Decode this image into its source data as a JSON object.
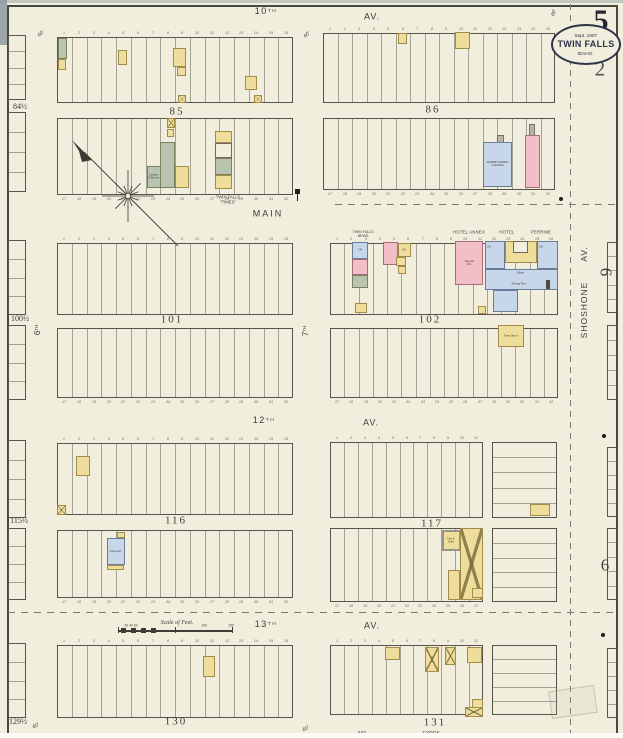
{
  "sheet": {
    "page_number": "5",
    "secondary_number": "2",
    "badge": {
      "line1": "Sept. 1907",
      "line2": "TWIN FALLS",
      "line3": "IDAHO."
    },
    "scale_label": "Scale of Feet.",
    "paper_color": "#f1eede",
    "ink_color": "#3e3d33",
    "building_colors": {
      "yellow": "#efdd9b",
      "pink": "#f2bec8",
      "blue": "#c7d6e9",
      "green": "#b9c3ad",
      "gray": "#b5b5ac"
    }
  },
  "texts": [
    {
      "t": "10",
      "sup": "TH",
      "x": 266,
      "y": 12,
      "fs": 9,
      "ls": 1.5
    },
    {
      "t": "AV.",
      "x": 372,
      "y": 17,
      "fs": 9,
      "ls": 1
    },
    {
      "t": "MAIN",
      "x": 268,
      "y": 214,
      "fs": 9,
      "ls": 2
    },
    {
      "t": "12",
      "sup": "TH",
      "x": 264,
      "y": 421,
      "fs": 9,
      "ls": 1.5
    },
    {
      "t": "AV.",
      "x": 371,
      "y": 423,
      "fs": 9,
      "ls": 1
    },
    {
      "t": "13",
      "sup": "TH",
      "x": 266,
      "y": 625,
      "fs": 9,
      "ls": 1.5
    },
    {
      "t": "AV.",
      "x": 372,
      "y": 626,
      "fs": 9,
      "ls": 1
    },
    {
      "t": "SHOSHONE",
      "x": 584,
      "y": 310,
      "fs": 8.5,
      "rot": -90,
      "ls": 1
    },
    {
      "t": "AV.",
      "x": 584,
      "y": 254,
      "fs": 8.5,
      "rot": -90,
      "ls": 1
    },
    {
      "t": "6",
      "sup": "TH",
      "x": 38,
      "y": 330,
      "fs": 8,
      "rot": -90
    },
    {
      "t": "7",
      "sup": "TH",
      "x": 306,
      "y": 331,
      "fs": 8,
      "rot": -90
    },
    {
      "t": "85",
      "x": 177,
      "y": 112,
      "fs": 11,
      "serif": 1,
      "ls": 2
    },
    {
      "t": "86",
      "x": 433,
      "y": 110,
      "fs": 11,
      "serif": 1,
      "ls": 2
    },
    {
      "t": "101",
      "x": 172,
      "y": 320,
      "fs": 11,
      "serif": 1,
      "ls": 2
    },
    {
      "t": "102",
      "x": 430,
      "y": 320,
      "fs": 11,
      "serif": 1,
      "ls": 2
    },
    {
      "t": "116",
      "x": 176,
      "y": 521,
      "fs": 11,
      "serif": 1,
      "ls": 2
    },
    {
      "t": "117",
      "x": 432,
      "y": 524,
      "fs": 11,
      "serif": 1,
      "ls": 2
    },
    {
      "t": "130",
      "x": 176,
      "y": 722,
      "fs": 11,
      "serif": 1,
      "ls": 2
    },
    {
      "t": "131",
      "x": 435,
      "y": 723,
      "fs": 11,
      "serif": 1,
      "ls": 2
    },
    {
      "t": "84½",
      "x": 20,
      "y": 107,
      "fs": 8,
      "serif": 1
    },
    {
      "t": "100½",
      "x": 20,
      "y": 319,
      "fs": 8,
      "serif": 1
    },
    {
      "t": "115½",
      "x": 19,
      "y": 521,
      "fs": 8,
      "serif": 1
    },
    {
      "t": "129½",
      "x": 18,
      "y": 722,
      "fs": 8,
      "serif": 1
    },
    {
      "t": "5",
      "x": 601,
      "y": 21,
      "fs": 30,
      "serif": 1,
      "bold": 1,
      "col": "#26262e"
    },
    {
      "t": "2",
      "x": 600,
      "y": 69,
      "fs": 21,
      "serif": 1,
      "col": "#54544e"
    },
    {
      "t": "6",
      "x": 606,
      "y": 272,
      "fs": 17,
      "serif": 1,
      "rot": 90,
      "col": "#45453e"
    },
    {
      "t": "6",
      "x": 605,
      "y": 565,
      "fs": 17,
      "serif": 1,
      "col": "#45453e"
    },
    {
      "t": "TWIN FALLS",
      "x": 228,
      "y": 197,
      "fs": 4.2
    },
    {
      "t": "\"TIMES\"",
      "x": 228,
      "y": 202,
      "fs": 4.2
    },
    {
      "t": "TWIN FALLS",
      "x": 363,
      "y": 232,
      "fs": 3.6
    },
    {
      "t": "NEWS",
      "x": 363,
      "y": 236,
      "fs": 3.6
    },
    {
      "t": "HOTEL ANNEX",
      "x": 469,
      "y": 232,
      "fs": 4.2,
      "ls": 0.5
    },
    {
      "t": "HOTEL",
      "x": 507,
      "y": 232,
      "fs": 4.2,
      "ls": 0.5
    },
    {
      "t": "PERRINE",
      "x": 541,
      "y": 232,
      "fs": 4.2,
      "ls": 0.5
    },
    {
      "t": "Off.",
      "x": 489,
      "y": 247,
      "fs": 3
    },
    {
      "t": "Off.",
      "x": 541,
      "y": 247,
      "fs": 3
    },
    {
      "t": "Office",
      "x": 520,
      "y": 273,
      "fs": 3
    },
    {
      "t": "Dining Rm.",
      "x": 519,
      "y": 284,
      "fs": 3
    },
    {
      "t": "NO",
      "x": 362,
      "y": 734,
      "fs": 5
    },
    {
      "t": "EXPOS-",
      "x": 432,
      "y": 734,
      "fs": 5
    },
    {
      "t": "Scale of Feet.",
      "x": 177,
      "y": 622,
      "fs": 6,
      "serif": 1,
      "italic": 1
    },
    {
      "t": "20 40 60",
      "x": 131,
      "y": 626,
      "fs": 3.4
    },
    {
      "t": "100",
      "x": 204,
      "y": 626,
      "fs": 3.4
    },
    {
      "t": "150",
      "x": 231,
      "y": 626,
      "fs": 3.4
    },
    {
      "t": "60'",
      "x": 41,
      "y": 34,
      "fs": 5,
      "italic": 1,
      "rot": -40
    },
    {
      "t": "60'",
      "x": 307,
      "y": 35,
      "fs": 5,
      "italic": 1,
      "rot": -40
    },
    {
      "t": "60'",
      "x": 36,
      "y": 726,
      "fs": 5,
      "italic": 1,
      "rot": -30
    },
    {
      "t": "60'",
      "x": 306,
      "y": 729,
      "fs": 5,
      "italic": 1,
      "rot": -30
    },
    {
      "t": "60'",
      "x": 554,
      "y": 13,
      "fs": 5,
      "italic": 1,
      "rot": -70
    }
  ],
  "blocks": [
    {
      "n": "block-85-upper",
      "x": 57,
      "y": 37,
      "w": 236,
      "h": 66,
      "lots": 16,
      "numTop": true
    },
    {
      "n": "block-85-lower",
      "x": 57,
      "y": 118,
      "w": 236,
      "h": 77,
      "lots": 16,
      "numBottom": true
    },
    {
      "n": "block-86-upper",
      "x": 323,
      "y": 33,
      "w": 232,
      "h": 70,
      "lots": 16,
      "numTop": true
    },
    {
      "n": "block-86-lower",
      "x": 323,
      "y": 118,
      "w": 232,
      "h": 72,
      "lots": 16,
      "numBottom": true
    },
    {
      "n": "block-101-upper",
      "x": 57,
      "y": 243,
      "w": 236,
      "h": 72,
      "lots": 16,
      "numTop": true
    },
    {
      "n": "block-101-lower",
      "x": 57,
      "y": 328,
      "w": 236,
      "h": 70,
      "lots": 16,
      "numBottom": true
    },
    {
      "n": "block-102-upper",
      "x": 330,
      "y": 243,
      "w": 228,
      "h": 72,
      "lots": 16,
      "numTop": true
    },
    {
      "n": "block-102-lower",
      "x": 330,
      "y": 328,
      "w": 228,
      "h": 70,
      "lots": 16,
      "numBottom": true
    },
    {
      "n": "block-116-upper",
      "x": 57,
      "y": 443,
      "w": 236,
      "h": 72,
      "lots": 16,
      "numTop": true
    },
    {
      "n": "block-116-lower",
      "x": 57,
      "y": 530,
      "w": 236,
      "h": 68,
      "lots": 16,
      "numBottom": true
    },
    {
      "n": "block-117-upper-west",
      "x": 330,
      "y": 442,
      "w": 153,
      "h": 76,
      "lots": 11,
      "numTop": true
    },
    {
      "n": "block-117-upper-east",
      "x": 492,
      "y": 442,
      "w": 65,
      "h": 76,
      "rows": 5
    },
    {
      "n": "block-117-lower-west",
      "x": 330,
      "y": 528,
      "w": 153,
      "h": 74,
      "lots": 11,
      "numBottom": true
    },
    {
      "n": "block-117-lower-east",
      "x": 492,
      "y": 528,
      "w": 65,
      "h": 74,
      "rows": 5
    },
    {
      "n": "block-130",
      "x": 57,
      "y": 645,
      "w": 236,
      "h": 73,
      "lots": 16,
      "numTop": true
    },
    {
      "n": "block-131-west",
      "x": 330,
      "y": 645,
      "w": 153,
      "h": 70,
      "lots": 11,
      "numTop": true
    },
    {
      "n": "block-131-east",
      "x": 492,
      "y": 645,
      "w": 65,
      "h": 70,
      "rows": 5
    },
    {
      "n": "edge-block-84-upper",
      "x": 8,
      "y": 35,
      "w": 18,
      "h": 65,
      "rows": 4
    },
    {
      "n": "edge-block-84-lower",
      "x": 8,
      "y": 112,
      "w": 18,
      "h": 80,
      "rows": 4
    },
    {
      "n": "edge-block-100-upper",
      "x": 8,
      "y": 240,
      "w": 18,
      "h": 75,
      "rows": 4
    },
    {
      "n": "edge-block-100-lower",
      "x": 8,
      "y": 325,
      "w": 18,
      "h": 75,
      "rows": 4
    },
    {
      "n": "edge-block-115-upper",
      "x": 8,
      "y": 440,
      "w": 18,
      "h": 78,
      "rows": 4
    },
    {
      "n": "edge-block-115-lower",
      "x": 8,
      "y": 528,
      "w": 18,
      "h": 72,
      "rows": 4
    },
    {
      "n": "edge-block-129",
      "x": 8,
      "y": 643,
      "w": 18,
      "h": 75,
      "rows": 4
    },
    {
      "n": "edge-block-east-row2-upper",
      "x": 607,
      "y": 242,
      "w": 11,
      "h": 71,
      "rows": 5
    },
    {
      "n": "edge-block-east-row2-lower",
      "x": 607,
      "y": 325,
      "w": 11,
      "h": 75,
      "rows": 5
    },
    {
      "n": "edge-block-east-row3-upper",
      "x": 607,
      "y": 447,
      "w": 11,
      "h": 70,
      "rows": 5
    },
    {
      "n": "edge-block-east-row3-lower",
      "x": 607,
      "y": 528,
      "w": 11,
      "h": 72,
      "rows": 5
    },
    {
      "n": "edge-block-east-row4",
      "x": 607,
      "y": 648,
      "w": 11,
      "h": 70,
      "rows": 5
    }
  ],
  "buildings": [
    {
      "x": 58,
      "y": 38,
      "w": 9,
      "h": 21,
      "c": "g"
    },
    {
      "x": 58,
      "y": 59,
      "w": 8,
      "h": 11,
      "c": "y"
    },
    {
      "x": 118,
      "y": 50,
      "w": 9,
      "h": 15,
      "c": "y"
    },
    {
      "x": 173,
      "y": 48,
      "w": 13,
      "h": 19,
      "c": "y"
    },
    {
      "x": 177,
      "y": 67,
      "w": 9,
      "h": 9,
      "c": "y"
    },
    {
      "x": 245,
      "y": 76,
      "w": 12,
      "h": 14,
      "c": "y"
    },
    {
      "x": 178,
      "y": 95,
      "w": 8,
      "h": 8,
      "c": "y",
      "xm": true
    },
    {
      "x": 254,
      "y": 95,
      "w": 8,
      "h": 8,
      "c": "y",
      "xm": true
    },
    {
      "x": 167,
      "y": 118,
      "w": 8,
      "h": 10,
      "c": "y",
      "xm": true
    },
    {
      "x": 167,
      "y": 129,
      "w": 7,
      "h": 8,
      "c": "y"
    },
    {
      "x": 160,
      "y": 142,
      "w": 15,
      "h": 46,
      "c": "g"
    },
    {
      "n": "building-laundry",
      "x": 147,
      "y": 166,
      "w": 14,
      "h": 22,
      "c": "g",
      "label": [
        "Laundry",
        "& Rooms"
      ],
      "fs": 2.6
    },
    {
      "x": 175,
      "y": 166,
      "w": 14,
      "h": 22,
      "c": "y"
    },
    {
      "n": "building-twin-falls-times",
      "x": 215,
      "y": 131,
      "w": 17,
      "h": 12,
      "c": "y"
    },
    {
      "x": 215,
      "y": 143,
      "w": 17,
      "h": 15,
      "c": "w"
    },
    {
      "x": 215,
      "y": 158,
      "w": 17,
      "h": 17,
      "c": "g"
    },
    {
      "x": 215,
      "y": 175,
      "w": 17,
      "h": 14,
      "c": "y"
    },
    {
      "x": 398,
      "y": 33,
      "w": 9,
      "h": 11,
      "c": "y"
    },
    {
      "x": 455,
      "y": 32,
      "w": 15,
      "h": 17,
      "c": "y"
    },
    {
      "x": 497,
      "y": 135,
      "w": 7,
      "h": 8,
      "c": "s"
    },
    {
      "n": "building-presbyterian-church",
      "x": 483,
      "y": 142,
      "w": 29,
      "h": 45,
      "c": "b",
      "label": [
        "PRESBYTERIAN",
        "CHURCH"
      ],
      "fs": 2.8
    },
    {
      "x": 529,
      "y": 124,
      "w": 6,
      "h": 12,
      "c": "s"
    },
    {
      "x": 525,
      "y": 135,
      "w": 15,
      "h": 53,
      "c": "p"
    },
    {
      "n": "building-twin-falls-news",
      "x": 352,
      "y": 242,
      "w": 16,
      "h": 17,
      "c": "b",
      "label": [
        "Off."
      ],
      "fs": 2.8
    },
    {
      "x": 352,
      "y": 259,
      "w": 16,
      "h": 16,
      "c": "p"
    },
    {
      "x": 352,
      "y": 275,
      "w": 16,
      "h": 13,
      "c": "g"
    },
    {
      "x": 355,
      "y": 303,
      "w": 12,
      "h": 10,
      "c": "y"
    },
    {
      "x": 383,
      "y": 242,
      "w": 15,
      "h": 23,
      "c": "p"
    },
    {
      "x": 398,
      "y": 243,
      "w": 13,
      "h": 14,
      "c": "y",
      "label": [
        "Off."
      ],
      "fs": 2.8
    },
    {
      "x": 396,
      "y": 257,
      "w": 10,
      "h": 9,
      "c": "y"
    },
    {
      "x": 398,
      "y": 266,
      "w": 8,
      "h": 8,
      "c": "y"
    },
    {
      "n": "building-hotel-annex",
      "x": 455,
      "y": 241,
      "w": 28,
      "h": 44,
      "c": "p",
      "label": [
        "Sample",
        "Rm."
      ],
      "fs": 2.8
    },
    {
      "x": 478,
      "y": 306,
      "w": 8,
      "h": 8,
      "c": "y"
    },
    {
      "n": "building-hotel-perrine",
      "x": 485,
      "y": 241,
      "w": 20,
      "h": 28,
      "c": "b"
    },
    {
      "x": 505,
      "y": 241,
      "w": 32,
      "h": 22,
      "c": "y"
    },
    {
      "x": 513,
      "y": 241,
      "w": 15,
      "h": 12,
      "c": "w"
    },
    {
      "x": 537,
      "y": 241,
      "w": 21,
      "h": 28,
      "c": "b"
    },
    {
      "x": 485,
      "y": 269,
      "w": 73,
      "h": 21,
      "c": "b"
    },
    {
      "x": 493,
      "y": 290,
      "w": 25,
      "h": 22,
      "c": "b"
    },
    {
      "x": 546,
      "y": 280,
      "w": 4,
      "h": 9,
      "c": "d"
    },
    {
      "n": "building-saw-shed",
      "x": 498,
      "y": 325,
      "w": 26,
      "h": 22,
      "c": "y",
      "label": [
        "Saw Shed"
      ],
      "fs": 3
    },
    {
      "x": 76,
      "y": 456,
      "w": 14,
      "h": 20,
      "c": "y"
    },
    {
      "x": 57,
      "y": 505,
      "w": 9,
      "h": 10,
      "c": "y",
      "xm": true
    },
    {
      "x": 117,
      "y": 532,
      "w": 8,
      "h": 6,
      "c": "y"
    },
    {
      "n": "building-carpenter-shop",
      "x": 107,
      "y": 538,
      "w": 18,
      "h": 27,
      "c": "b",
      "label": [
        "Carpenter"
      ],
      "fs": 2.6
    },
    {
      "x": 107,
      "y": 565,
      "w": 17,
      "h": 5,
      "c": "y"
    },
    {
      "x": 530,
      "y": 504,
      "w": 20,
      "h": 12,
      "c": "y"
    },
    {
      "n": "building-hay-grain",
      "x": 442,
      "y": 530,
      "w": 19,
      "h": 21,
      "c": "y",
      "label": [
        "Hay &",
        "Grain"
      ],
      "fs": 2.6,
      "thick": true
    },
    {
      "n": "building-livery-barn",
      "x": 460,
      "y": 528,
      "w": 23,
      "h": 72,
      "c": "y",
      "xm": true
    },
    {
      "x": 448,
      "y": 570,
      "w": 12,
      "h": 30,
      "c": "y"
    },
    {
      "x": 472,
      "y": 588,
      "w": 11,
      "h": 10,
      "c": "y"
    },
    {
      "x": 203,
      "y": 656,
      "w": 12,
      "h": 21,
      "c": "y"
    },
    {
      "x": 385,
      "y": 647,
      "w": 15,
      "h": 13,
      "c": "y"
    },
    {
      "x": 425,
      "y": 647,
      "w": 14,
      "h": 25,
      "c": "y",
      "xm": true
    },
    {
      "x": 445,
      "y": 647,
      "w": 11,
      "h": 18,
      "c": "y",
      "xm": true
    },
    {
      "x": 467,
      "y": 647,
      "w": 15,
      "h": 16,
      "c": "y"
    },
    {
      "x": 472,
      "y": 699,
      "w": 11,
      "h": 10,
      "c": "y"
    },
    {
      "x": 465,
      "y": 707,
      "w": 18,
      "h": 10,
      "c": "y",
      "xm": true
    }
  ],
  "dashes": [
    {
      "dir": "v",
      "x": 570,
      "y1": 4,
      "y2": 738
    },
    {
      "dir": "h",
      "y": 204,
      "x1": 335,
      "x2": 617
    },
    {
      "dir": "h",
      "y": 612,
      "x1": 8,
      "x2": 617
    }
  ],
  "markers": [
    {
      "x": 559,
      "y": 197
    },
    {
      "x": 602,
      "y": 434
    },
    {
      "x": 601,
      "y": 633
    },
    {
      "x": 295,
      "y": 189,
      "pipe": true
    }
  ]
}
